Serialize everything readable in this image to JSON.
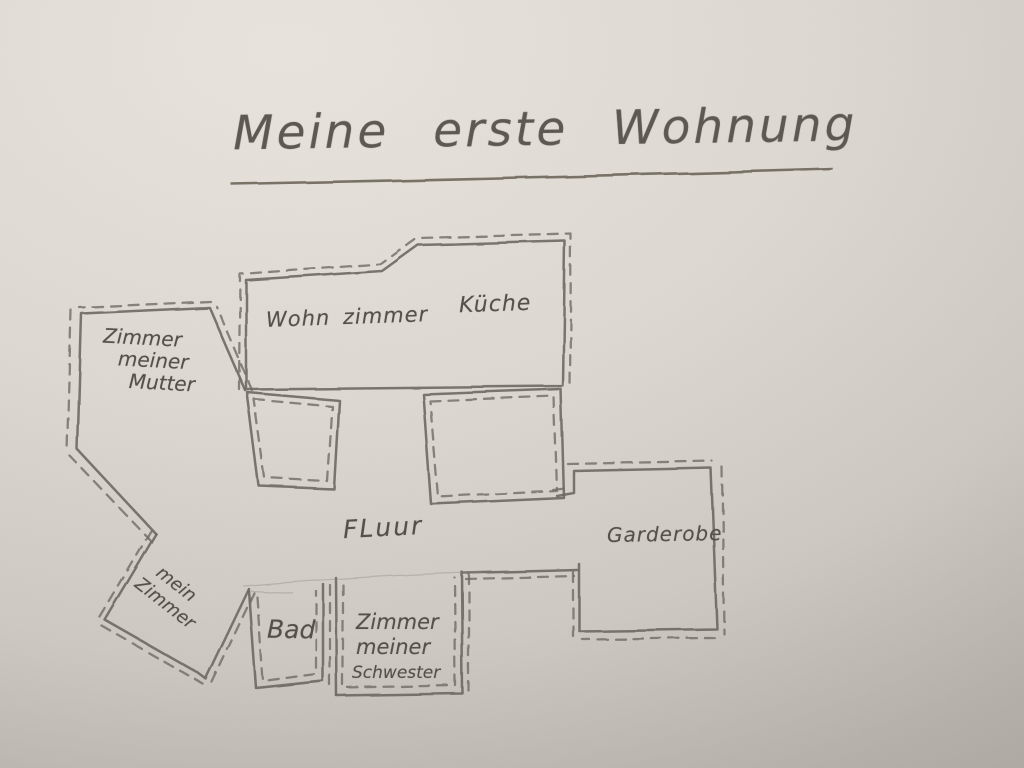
{
  "title": "Meine erste Wohnung",
  "rooms": {
    "mutter": {
      "line1": "Zimmer",
      "line2": "meiner",
      "line3": "Mutter"
    },
    "wohnzimmer": {
      "label": "Wohn zimmer"
    },
    "kueche": {
      "label": "Küche"
    },
    "fluur": {
      "label": "FLuur"
    },
    "garderobe": {
      "label": "Garderobe"
    },
    "mein_zimmer": {
      "line1": "mein",
      "line2": "Zimmer"
    },
    "bad": {
      "label": "Bad"
    },
    "schwester": {
      "line1": "Zimmer",
      "line2": "meiner",
      "line3": "Schwester"
    }
  },
  "colors": {
    "paper_light": "#e9e5de",
    "paper_dark": "#a6a19a",
    "pencil": "#6b675f",
    "label_text": "#55514a"
  }
}
